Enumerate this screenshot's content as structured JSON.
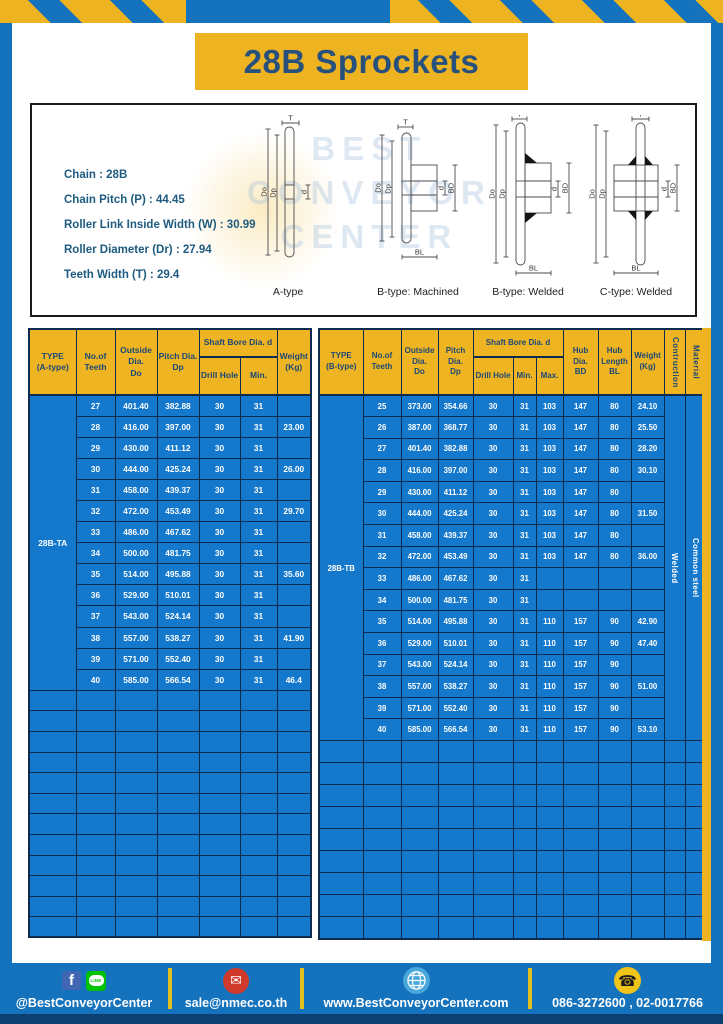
{
  "page": {
    "title": "28B Sprockets"
  },
  "specs": {
    "lines": [
      "Chain  : 28B",
      "Chain Pitch (P)  : 44.45",
      "Roller Link Inside Width (W)  : 30.99",
      "Roller Diameter (Dr)  : 27.94",
      "Teeth Width (T)  : 29.4"
    ]
  },
  "watermark": {
    "text": "BEST\nCONVEYOR\nCENTER"
  },
  "diagrams": {
    "labels": [
      "A-type",
      "B-type: Machined",
      "B-type: Welded",
      "C-type: Welded"
    ],
    "dims": {
      "t": "T",
      "do": "Do",
      "dp": "Dp",
      "d": "d",
      "bd": "BD",
      "bl": "BL"
    }
  },
  "tables": {
    "left": {
      "headers": {
        "type": "TYPE\n(A-type)",
        "teeth": "No.of\nTeeth",
        "outside": "Outside\nDia.\nDo",
        "pitch": "Pitch Dia.\nDp",
        "shaft_bore": "Shaft Bore Dia. d",
        "drill": "Drill Hole",
        "min": "Min.",
        "weight": "Weight\n(Kg)"
      },
      "type_label": "28B-TA",
      "rows": [
        [
          "27",
          "401.40",
          "382.88",
          "30",
          "31",
          ""
        ],
        [
          "28",
          "416.00",
          "397.00",
          "30",
          "31",
          "23.00"
        ],
        [
          "29",
          "430.00",
          "411.12",
          "30",
          "31",
          ""
        ],
        [
          "30",
          "444.00",
          "425.24",
          "30",
          "31",
          "26.00"
        ],
        [
          "31",
          "458.00",
          "439.37",
          "30",
          "31",
          ""
        ],
        [
          "32",
          "472.00",
          "453.49",
          "30",
          "31",
          "29.70"
        ],
        [
          "33",
          "486.00",
          "467.62",
          "30",
          "31",
          ""
        ],
        [
          "34",
          "500.00",
          "481.75",
          "30",
          "31",
          ""
        ],
        [
          "35",
          "514.00",
          "495.88",
          "30",
          "31",
          "35.60"
        ],
        [
          "36",
          "529.00",
          "510.01",
          "30",
          "31",
          ""
        ],
        [
          "37",
          "543.00",
          "524.14",
          "30",
          "31",
          ""
        ],
        [
          "38",
          "557.00",
          "538.27",
          "30",
          "31",
          "41.90"
        ],
        [
          "39",
          "571.00",
          "552.40",
          "30",
          "31",
          ""
        ],
        [
          "40",
          "585.00",
          "566.54",
          "30",
          "31",
          "46.4"
        ]
      ],
      "empty_rows": 12
    },
    "right": {
      "headers": {
        "type": "TYPE\n(B-type)",
        "teeth": "No.of\nTeeth",
        "outside": "Outside\nDia.\nDo",
        "pitch": "Pitch Dia.\nDp",
        "shaft_bore": "Shaft Bore Dia. d",
        "drill": "Drill Hole",
        "min": "Min.",
        "max": "Max.",
        "hub_dia": "Hub Dia.\nBD",
        "hub_len": "Hub\nLength\nBL",
        "weight": "Weight\n(Kg)",
        "construction": "Contruction",
        "material": "Material"
      },
      "type_label": "28B-TB",
      "construction_value": "Welded",
      "material_value": "Common steel",
      "rows": [
        [
          "25",
          "373.00",
          "354.66",
          "30",
          "31",
          "103",
          "147",
          "80",
          "24.10"
        ],
        [
          "26",
          "387.00",
          "368.77",
          "30",
          "31",
          "103",
          "147",
          "80",
          "25.50"
        ],
        [
          "27",
          "401.40",
          "382.88",
          "30",
          "31",
          "103",
          "147",
          "80",
          "28.20"
        ],
        [
          "28",
          "416.00",
          "397.00",
          "30",
          "31",
          "103",
          "147",
          "80",
          "30.10"
        ],
        [
          "29",
          "430.00",
          "411.12",
          "30",
          "31",
          "103",
          "147",
          "80",
          ""
        ],
        [
          "30",
          "444.00",
          "425.24",
          "30",
          "31",
          "103",
          "147",
          "80",
          "31.50"
        ],
        [
          "31",
          "458.00",
          "439.37",
          "30",
          "31",
          "103",
          "147",
          "80",
          ""
        ],
        [
          "32",
          "472.00",
          "453.49",
          "30",
          "31",
          "103",
          "147",
          "80",
          "36.00"
        ],
        [
          "33",
          "486.00",
          "467.62",
          "30",
          "31",
          "",
          "",
          "",
          ""
        ],
        [
          "34",
          "500.00",
          "481.75",
          "30",
          "31",
          "",
          "",
          "",
          ""
        ],
        [
          "35",
          "514.00",
          "495.88",
          "30",
          "31",
          "110",
          "157",
          "90",
          "42.90"
        ],
        [
          "36",
          "529.00",
          "510.01",
          "30",
          "31",
          "110",
          "157",
          "90",
          "47.40"
        ],
        [
          "37",
          "543.00",
          "524.14",
          "30",
          "31",
          "110",
          "157",
          "90",
          ""
        ],
        [
          "38",
          "557.00",
          "538.27",
          "30",
          "31",
          "110",
          "157",
          "90",
          "51.00"
        ],
        [
          "39",
          "571.00",
          "552.40",
          "30",
          "31",
          "110",
          "157",
          "90",
          ""
        ],
        [
          "40",
          "585.00",
          "566.54",
          "30",
          "31",
          "110",
          "157",
          "90",
          "53.10"
        ]
      ],
      "empty_rows": 9
    }
  },
  "footer": {
    "social_label": "@BestConveyorCenter",
    "line_icon_text": "LINE",
    "fb_icon_text": "f",
    "email": "sale@nmec.co.th",
    "website": "www.BestConveyorCenter.com",
    "phones": "086-3272600 , 02-0017766"
  }
}
